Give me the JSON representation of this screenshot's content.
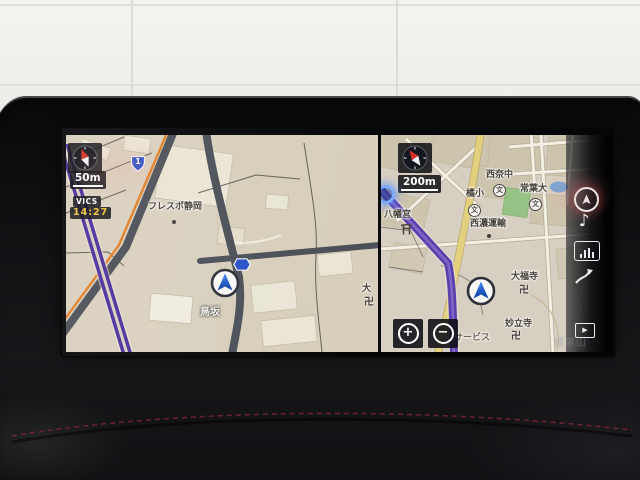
{
  "left_map": {
    "scale_label": "50m",
    "vics_label": "VICS",
    "vics_time": "14:27",
    "shield_national_route": "1",
    "shield_prefectural_route": "67",
    "labels": {
      "frespo": "フレスポ静岡",
      "torisaka": "鳥坂",
      "temple_partial": "大",
      "temple_manji": "卍"
    }
  },
  "right_map": {
    "scale_label": "200m",
    "labels": {
      "hachimangu": "八幡宮",
      "nishina_jhs": "西奈中",
      "tokoha_univ": "常葉大",
      "tachibana_es": "橘小",
      "seino_transport": "西濃運輸",
      "daifukuji": "大福寺",
      "daifukuji_manji": "卍",
      "myoryuji": "妙立寺",
      "myoryuji_manji": "卍",
      "service": "サービス",
      "school_symbol": "文"
    },
    "zoom_in_glyph": "+",
    "zoom_out_glyph": "−"
  },
  "sidebar": {
    "icons": [
      {
        "name": "current-position-icon"
      },
      {
        "name": "music-note-icon",
        "glyph": "♪"
      },
      {
        "name": "equalizer-icon"
      },
      {
        "name": "route-arrow-icon"
      },
      {
        "name": "video-screen-icon",
        "glyph": "▶"
      }
    ]
  },
  "ghost_text": "榎原山",
  "colors": {
    "map_bg_left": "#d9d1bf",
    "map_bg_right": "#d7cfc1",
    "route_purple": "#5a41ae",
    "vics_orange": "#e08028",
    "road_dark": "#4b5058",
    "road_yellow": "#e3d07e",
    "shield_blue": "#2a52c8",
    "marker_blue": "#1a5fd0",
    "vics_time_yellow": "#f0c43a",
    "stitch_red": "#7a2531"
  }
}
